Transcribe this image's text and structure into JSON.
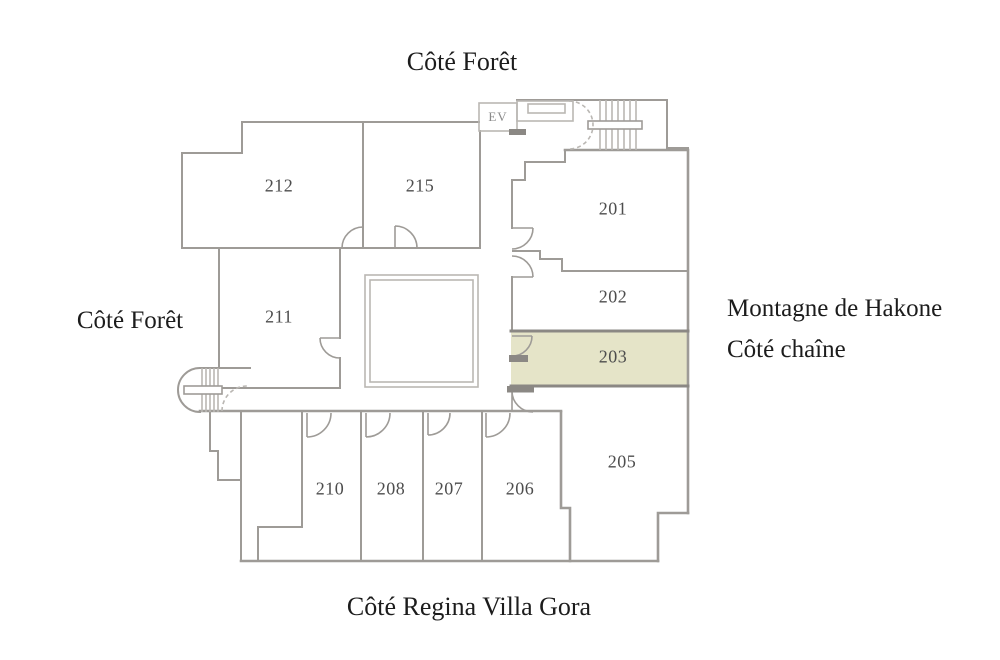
{
  "title_top": "Côté Forêt",
  "side_labels": {
    "left": "Côté Forêt",
    "right_line1": "Montagne de Hakone",
    "right_line2": "Côté chaîne",
    "bottom": "Côté Regina Villa Gora"
  },
  "elevator": {
    "label": "EV"
  },
  "highlighted_room": "203",
  "rooms": [
    {
      "number": "212",
      "x": 279,
      "y": 186
    },
    {
      "number": "215",
      "x": 420,
      "y": 186
    },
    {
      "number": "201",
      "x": 613,
      "y": 209
    },
    {
      "number": "202",
      "x": 613,
      "y": 297
    },
    {
      "number": "203",
      "x": 613,
      "y": 357,
      "highlighted": true
    },
    {
      "number": "205",
      "x": 622,
      "y": 462
    },
    {
      "number": "211",
      "x": 279,
      "y": 317
    },
    {
      "number": "210",
      "x": 330,
      "y": 489
    },
    {
      "number": "208",
      "x": 391,
      "y": 489
    },
    {
      "number": "207",
      "x": 449,
      "y": 489
    },
    {
      "number": "206",
      "x": 520,
      "y": 489
    }
  ],
  "colors": {
    "background": "#ffffff",
    "wall": "#9e9b97",
    "wall_light": "#bab7b3",
    "wall_dark": "#8b8884",
    "highlight_fill": "#e5e4c8",
    "room_text": "#4d4d4d",
    "label_text": "#1c1c1c"
  }
}
